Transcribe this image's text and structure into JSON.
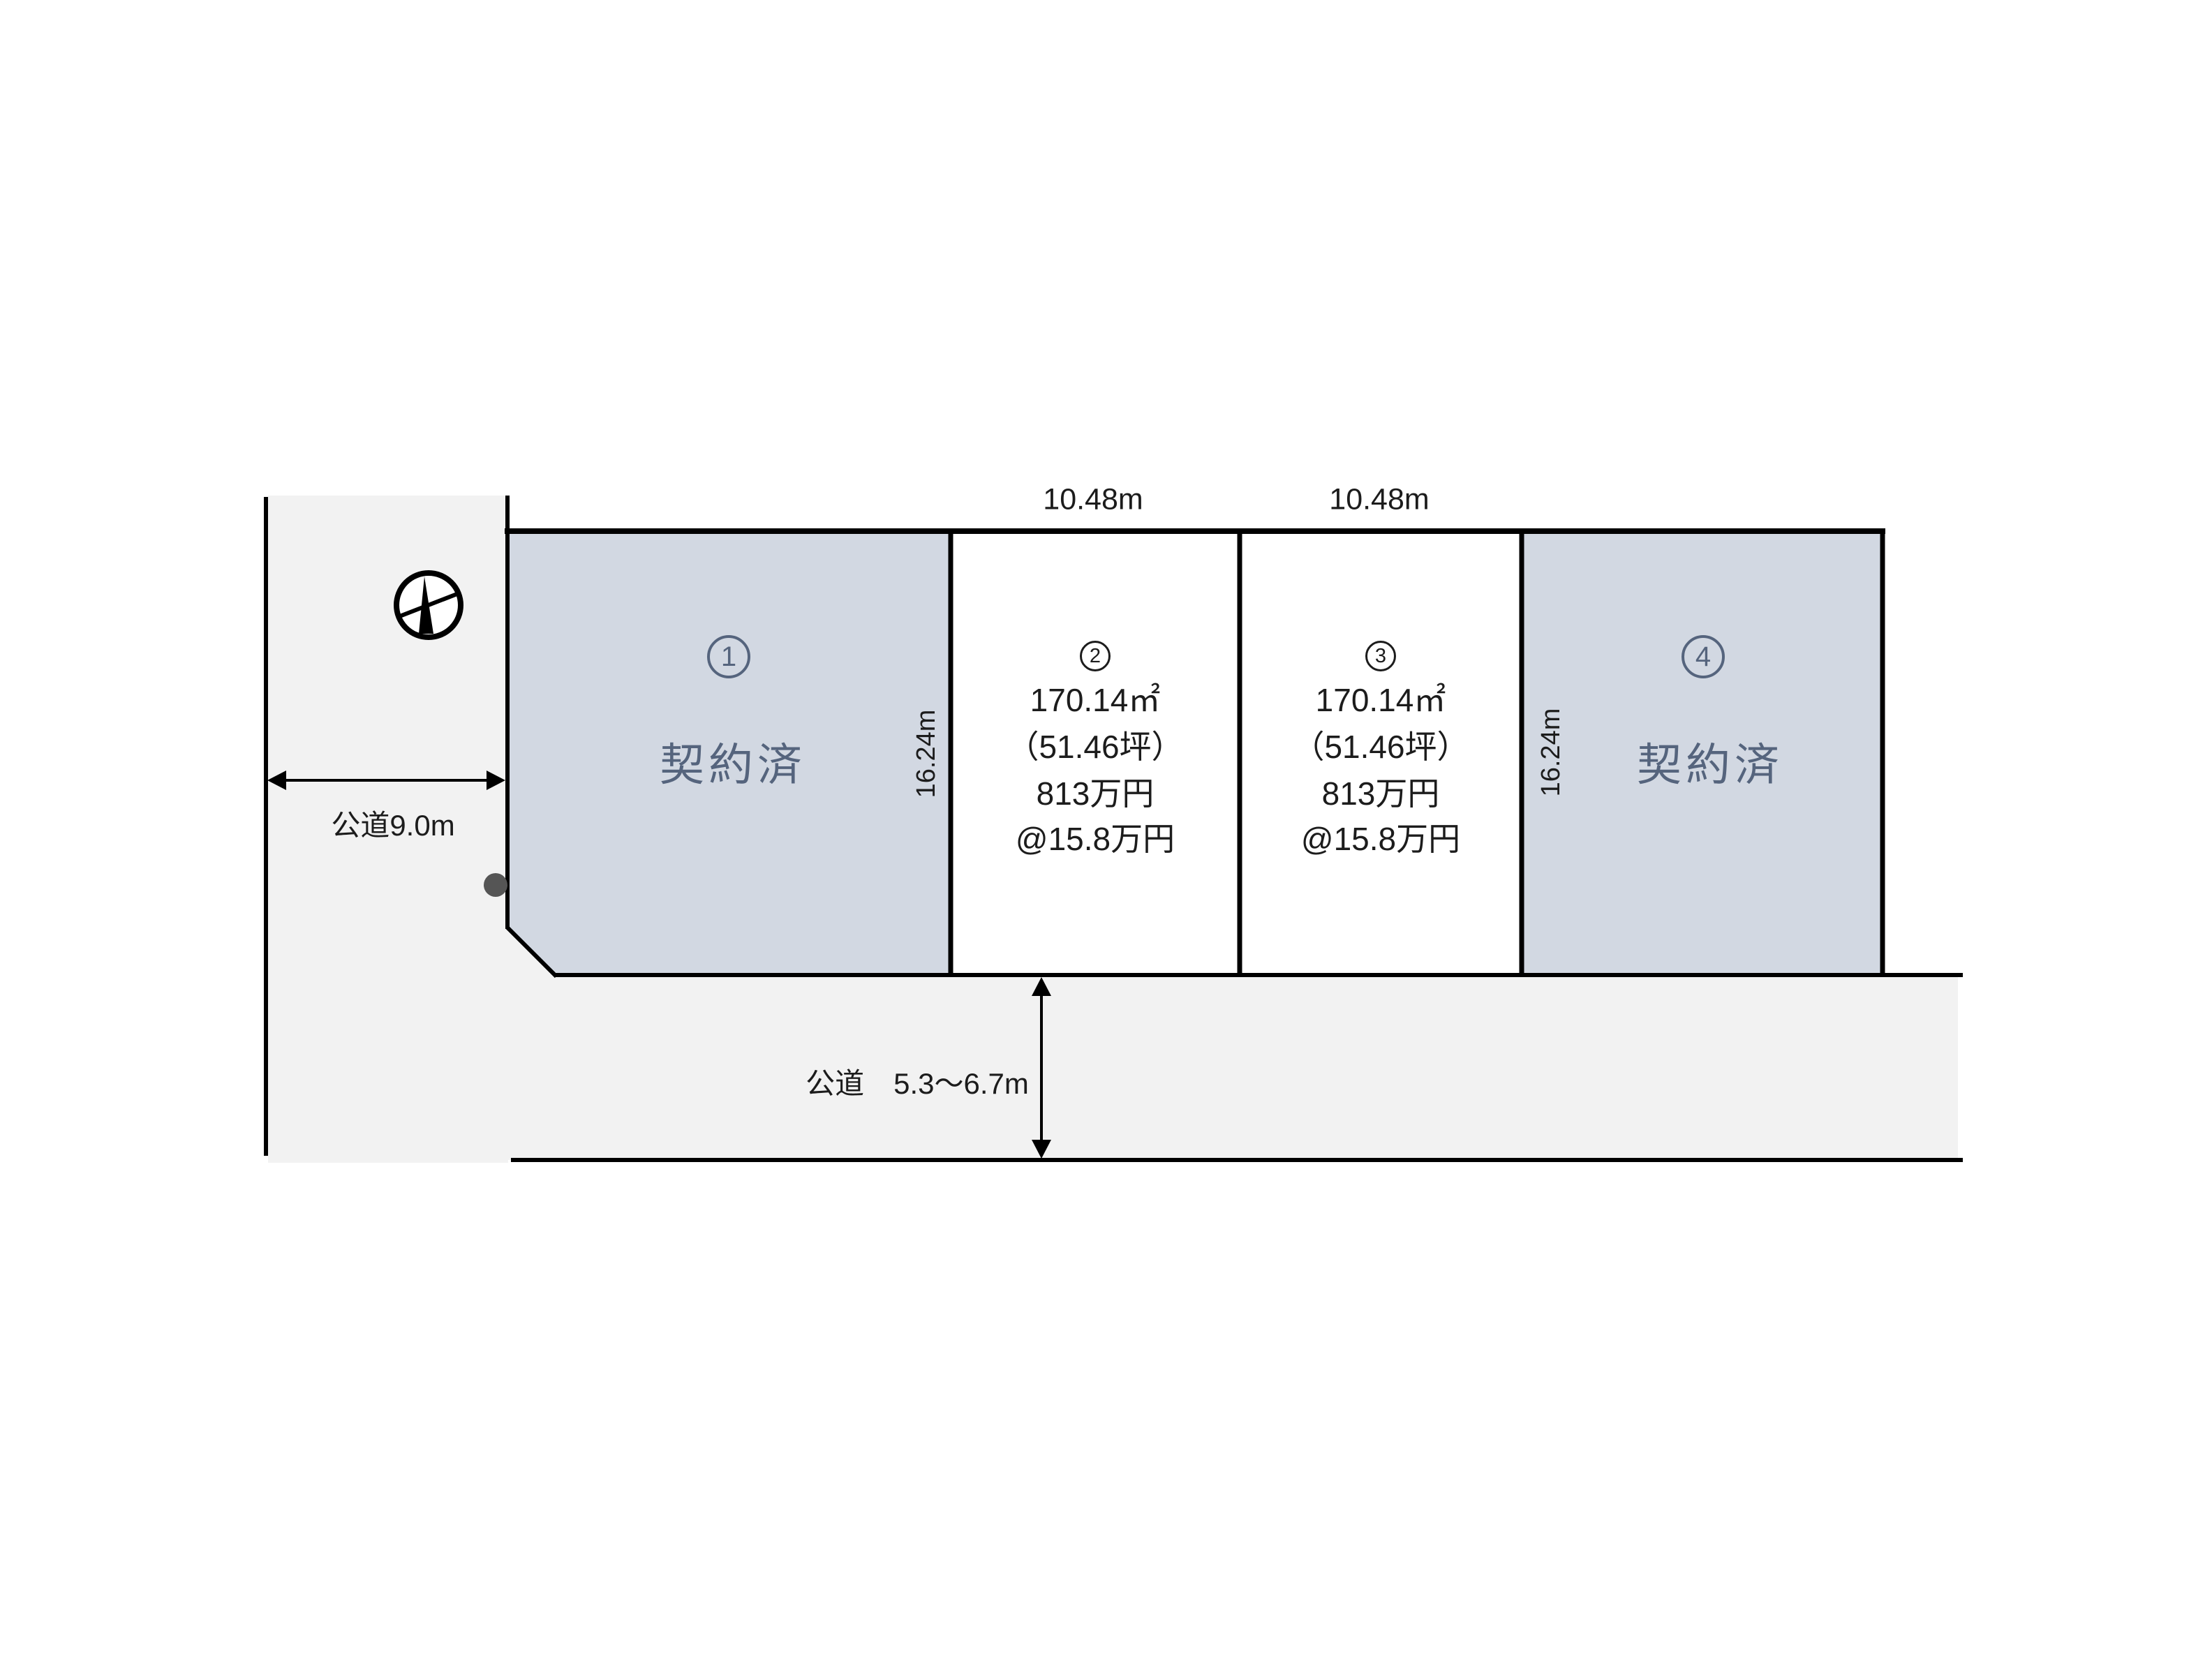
{
  "diagram": {
    "type": "land-subdivision-plan",
    "compass": {
      "icon": "north-compass"
    },
    "roads": {
      "left": {
        "label": "公道9.0m"
      },
      "bottom": {
        "label": "公道　5.3〜6.7m"
      }
    },
    "dimensions": {
      "top_width_plot2": "10.48m",
      "top_width_plot3": "10.48m",
      "depth_left": "16.24m",
      "depth_right": "16.24m"
    },
    "plots": [
      {
        "digit": "1",
        "number": "①",
        "status": "契約済"
      },
      {
        "digit": "2",
        "number": "②",
        "area": "170.14㎡",
        "area_tsubo": "（51.46坪）",
        "price": "813万円",
        "unit_price": "@15.8万円"
      },
      {
        "digit": "3",
        "number": "③",
        "area": "170.14㎡",
        "area_tsubo": "（51.46坪）",
        "price": "813万円",
        "unit_price": "@15.8万円"
      },
      {
        "digit": "4",
        "number": "④",
        "status": "契約済"
      }
    ],
    "colors": {
      "sold_plot_fill": "#d2d8e2",
      "available_plot_fill": "#ffffff",
      "road_fill": "#f2f2f2",
      "sold_plot_text": "#55647d",
      "text": "#1c1c1c",
      "line": "#000000",
      "corner_dot": "#555555"
    }
  }
}
